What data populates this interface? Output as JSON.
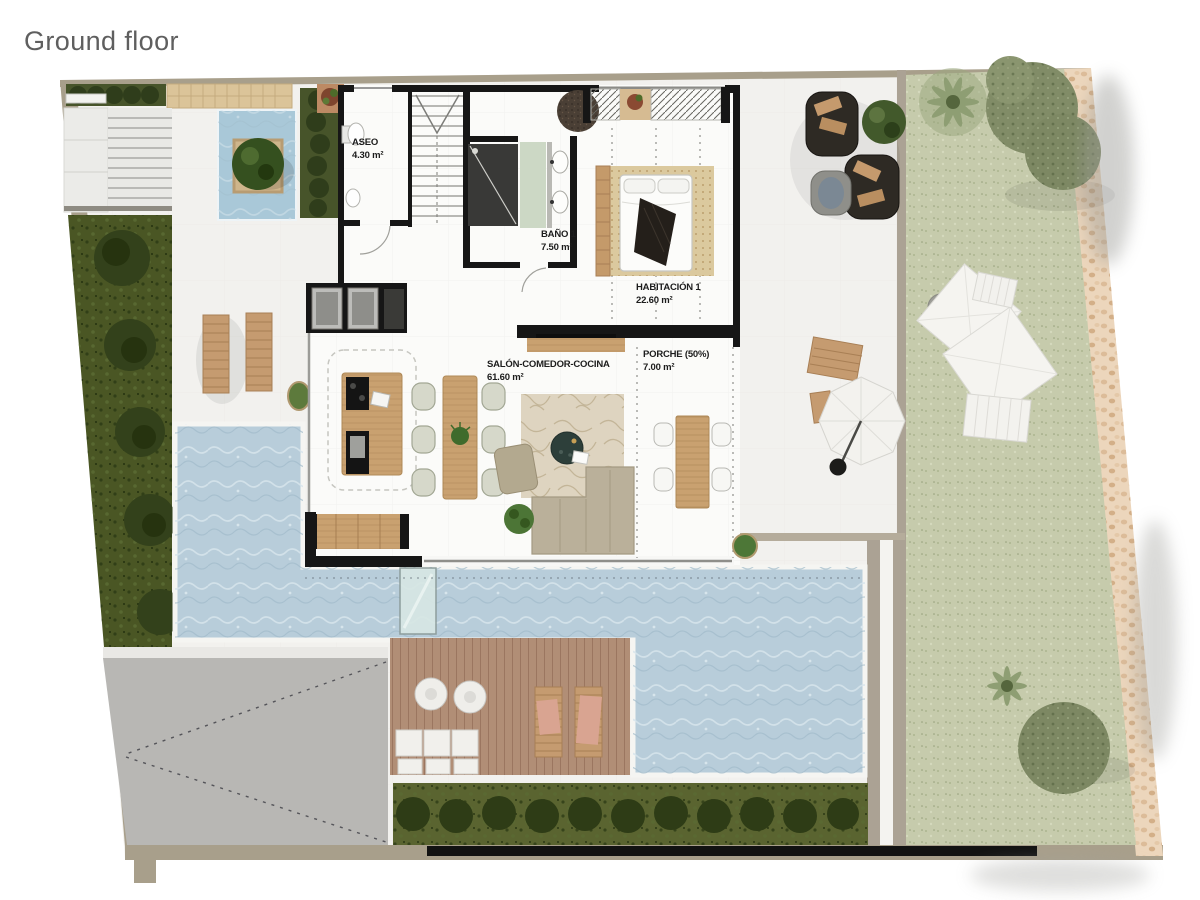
{
  "title": "Ground floor",
  "rooms": [
    {
      "name": "ASEO",
      "area": "4.30 m²"
    },
    {
      "name": "BAÑO 1",
      "area": "7.50 m²"
    },
    {
      "name": "HABITACIÓN 1",
      "area": "22.60 m²"
    },
    {
      "name": "SALÓN-COMEDOR-COCINA",
      "area": "61.60 m²"
    },
    {
      "name": "PORCHE (50%)",
      "area": "7.00 m²"
    }
  ],
  "colors": {
    "wall": "#161616",
    "pool_water": "#b8cdda",
    "courtyard_water": "#a9c8d8",
    "lawn": "#c6cbac",
    "garden": "#4a5624",
    "hedge": "#47542a",
    "deck_wood": "#b18e76",
    "furniture_wood": "#c9a170",
    "driveway": "#b8b7b4",
    "boundary": "#a89f8b",
    "stone_path": "#ecd6bc",
    "label_text": "#1c1c1c"
  }
}
